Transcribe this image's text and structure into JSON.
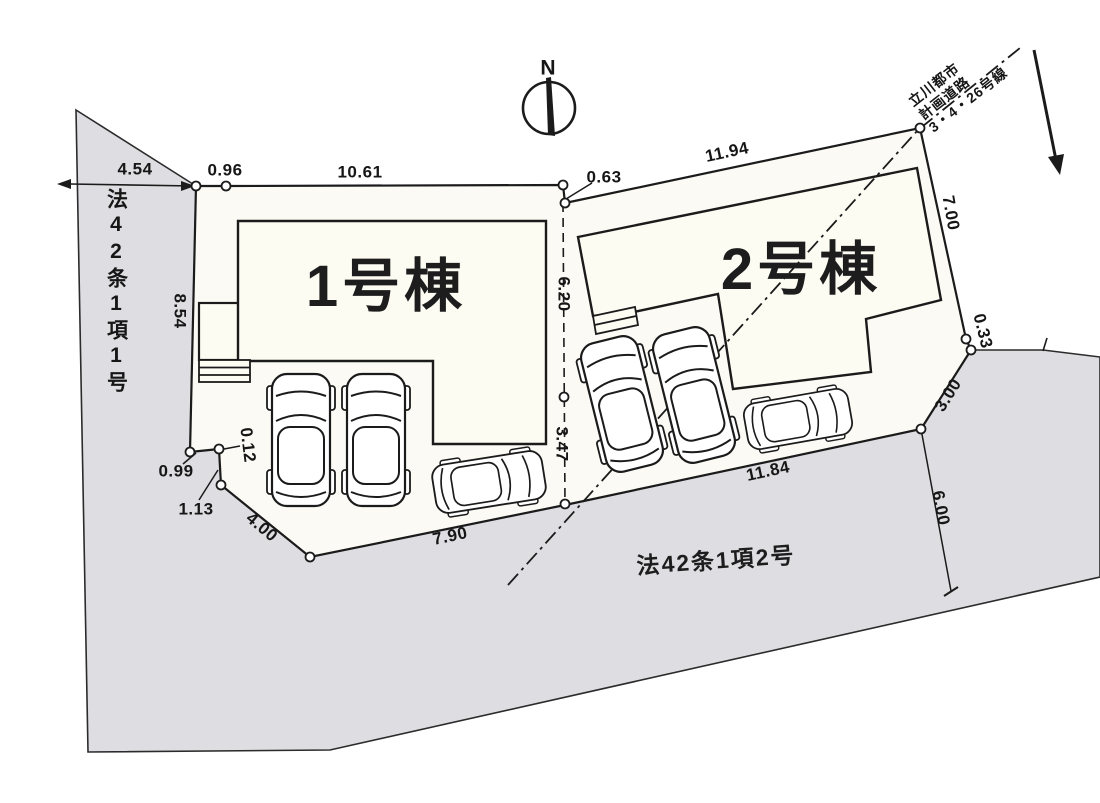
{
  "plan": {
    "north_label": "N",
    "buildings": [
      {
        "label": "1号棟"
      },
      {
        "label": "2号棟"
      }
    ],
    "roads": {
      "left_road": "法42条1項1号",
      "bottom_road": "法42条1項2号",
      "planned_road_line1": "立川都市",
      "planned_road_line2": "計画道路",
      "planned_road_line3": "3・4・26号線"
    },
    "dimensions": {
      "top_road_width": "4.54",
      "top_edge_jog": "0.96",
      "lot1_frontage": "10.61",
      "divider_offset": "0.63",
      "lot2_frontage": "11.94",
      "lot2_right_side": "7.00",
      "right_corner_jog": "0.33",
      "corner_cut": "3.00",
      "east_road_width": "6.00",
      "lot2_south": "11.84",
      "lot1_south": "7.90",
      "lot1_southwest": "4.00",
      "west_jog_1": "1.13",
      "west_jog_2": "0.99",
      "west_jog_3": "0.12",
      "lot1_west_side": "8.54",
      "divider_upper": "6.20",
      "divider_lower": "3.47"
    },
    "colors": {
      "road_fill": "#dedee2",
      "parcel_fill": "#fbfaf4",
      "building_fill": "#fdfcf3",
      "line": "#1b1b1b"
    }
  }
}
